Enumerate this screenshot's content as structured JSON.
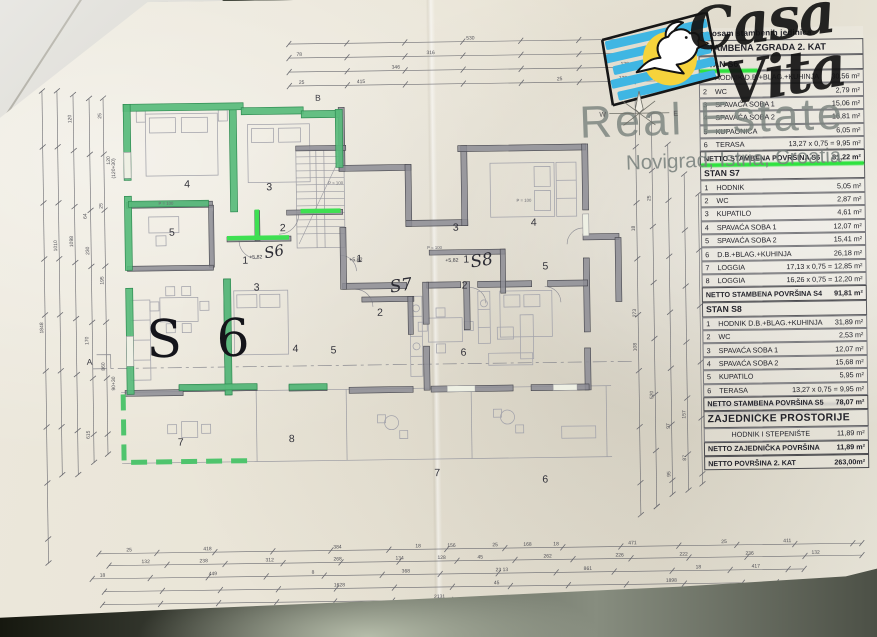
{
  "watermark": {
    "brand_script_1": "Casa",
    "brand_script_2": "Vita",
    "brand_line1": "Real Estate",
    "brand_line2": "Novigrad, Istria, Croatia"
  },
  "table": {
    "pre_title": "sa osam stambenih jedinica",
    "title": "STAMBENA ZGRADA 2. KAT",
    "rows": [
      {
        "type": "section",
        "label": "STAN S6",
        "highlight": "part"
      },
      {
        "type": "item",
        "n": "1",
        "label": "HODNIK D.B.+BLAG.+KUHINJA",
        "value": "30,56 m²"
      },
      {
        "type": "item",
        "n": "2",
        "label": "WC",
        "value": "2,79 m²"
      },
      {
        "type": "item",
        "n": "3",
        "label": "SPAVAĆA SOBA 1",
        "value": "15,06 m²"
      },
      {
        "type": "item",
        "n": "4",
        "label": "SPAVAĆA SOBA 2",
        "value": "16,81 m²"
      },
      {
        "type": "item",
        "n": "5",
        "label": "KUPAONICA",
        "value": "6,05 m²"
      },
      {
        "type": "item",
        "n": "6",
        "label": "TERASA",
        "value": "13,27 x 0,75 = 9,95 m²"
      },
      {
        "type": "total",
        "label": "NETTO STAMBENA POVRŠINA S6",
        "value": "81,22 m²",
        "highlight": "full"
      },
      {
        "type": "section",
        "label": "STAN S7"
      },
      {
        "type": "item",
        "n": "1",
        "label": "HODNIK",
        "value": "5,05 m²"
      },
      {
        "type": "item",
        "n": "2",
        "label": "WC",
        "value": "2,87 m²"
      },
      {
        "type": "item",
        "n": "3",
        "label": "KUPATILO",
        "value": "4,61 m²"
      },
      {
        "type": "item",
        "n": "4",
        "label": "SPAVAĆA SOBA 1",
        "value": "12,07 m²"
      },
      {
        "type": "item",
        "n": "5",
        "label": "SPAVAĆA SOBA 2",
        "value": "15,41 m²"
      },
      {
        "type": "item",
        "n": "6",
        "label": "D.B.+BLAG.+KUHINJA",
        "value": "26,18 m²"
      },
      {
        "type": "item",
        "n": "7",
        "label": "LOGGIA",
        "value": "17,13 x 0,75 = 12,85 m²"
      },
      {
        "type": "item",
        "n": "8",
        "label": "LOGGIA",
        "value": "16,26 x 0,75 = 12,20 m²"
      },
      {
        "type": "total",
        "label": "NETTO STAMBENA POVRŠINA S4",
        "value": "91,81 m²"
      },
      {
        "type": "section",
        "label": "STAN S8"
      },
      {
        "type": "item",
        "n": "1",
        "label": "HODNIK D.B.+BLAG.+KUHINJA",
        "value": "31,89 m²"
      },
      {
        "type": "item",
        "n": "2",
        "label": "WC",
        "value": "2,53 m²"
      },
      {
        "type": "item",
        "n": "3",
        "label": "SPAVAĆA SOBA 1",
        "value": "12,07 m²"
      },
      {
        "type": "item",
        "n": "4",
        "label": "SPAVAĆA SOBA 2",
        "value": "15,68 m²"
      },
      {
        "type": "item",
        "n": "5",
        "label": "KUPATILO",
        "value": "5,95 m²"
      },
      {
        "type": "item",
        "n": "6",
        "label": "TERASA",
        "value": "13,27 x 0,75 = 9,95 m²"
      },
      {
        "type": "total",
        "label": "NETTO STAMBENA POVRŠINA S5",
        "value": "78,07 m²"
      },
      {
        "type": "section-big",
        "label": "ZAJEDNIČKE PROSTORIJE"
      },
      {
        "type": "common",
        "label": "HODNIK I STEPENIŠTE",
        "value": "11,89 m²"
      },
      {
        "type": "total",
        "label": "NETTO ZAJEDNIČKA POVRŠINA",
        "value": "11,89 m²"
      },
      {
        "type": "total",
        "label": "NETTO POVRŠINA 2. KAT",
        "value": "263,00m²"
      }
    ]
  },
  "plan": {
    "big_unit_label": "S 6",
    "script_labels": [
      {
        "t": "S6",
        "x": 266,
        "y": 258,
        "s": 15,
        "r": -10
      },
      {
        "t": "S7",
        "x": 391,
        "y": 294,
        "s": 17,
        "r": -8
      },
      {
        "t": "S8",
        "x": 472,
        "y": 270,
        "s": 17,
        "r": -8
      }
    ],
    "room_numbers": [
      {
        "t": "4",
        "x": 186,
        "y": 186
      },
      {
        "t": "3",
        "x": 268,
        "y": 190
      },
      {
        "t": "5",
        "x": 170,
        "y": 234
      },
      {
        "t": "2",
        "x": 281,
        "y": 231
      },
      {
        "t": "1",
        "x": 243,
        "y": 263
      },
      {
        "t": "3",
        "x": 254,
        "y": 290
      },
      {
        "t": "4",
        "x": 292,
        "y": 352
      },
      {
        "t": "5",
        "x": 330,
        "y": 354
      },
      {
        "t": "7",
        "x": 176,
        "y": 444
      },
      {
        "t": "8",
        "x": 287,
        "y": 442
      },
      {
        "t": "1",
        "x": 357,
        "y": 263
      },
      {
        "t": "2",
        "x": 377,
        "y": 317
      },
      {
        "t": "6",
        "x": 460,
        "y": 358
      },
      {
        "t": "1",
        "x": 464,
        "y": 265
      },
      {
        "t": "2",
        "x": 462,
        "y": 291
      },
      {
        "t": "3",
        "x": 454,
        "y": 233
      },
      {
        "t": "4",
        "x": 532,
        "y": 229
      },
      {
        "t": "5",
        "x": 543,
        "y": 273
      },
      {
        "t": "7",
        "x": 432,
        "y": 478
      },
      {
        "t": "6",
        "x": 540,
        "y": 486
      }
    ],
    "level_marks": [
      {
        "t": "+5,82",
        "x": 250,
        "y": 258
      },
      {
        "t": "+5,82",
        "x": 350,
        "y": 262
      },
      {
        "t": "+5,82",
        "x": 446,
        "y": 264
      }
    ],
    "parapet_notes": [
      {
        "t": "P = 100",
        "x": 160,
        "y": 203
      },
      {
        "t": "P = 100",
        "x": 330,
        "y": 185
      },
      {
        "t": "P = 100",
        "x": 428,
        "y": 251
      },
      {
        "t": "P = 100",
        "x": 518,
        "y": 205
      }
    ],
    "grid_marks": [
      {
        "t": "B",
        "x": 318,
        "y": 101
      },
      {
        "t": "A",
        "x": 86,
        "y": 362
      }
    ],
    "dim_labels": [
      {
        "t": "530",
        "x": 470,
        "y": 42
      },
      {
        "t": "316",
        "x": 430,
        "y": 56
      },
      {
        "t": "78",
        "x": 300,
        "y": 56
      },
      {
        "t": "18",
        "x": 652,
        "y": 56
      },
      {
        "t": "346",
        "x": 395,
        "y": 70
      },
      {
        "t": "120",
        "x": 624,
        "y": 70
      },
      {
        "t": "132",
        "x": 662,
        "y": 70
      },
      {
        "t": "98",
        "x": 694,
        "y": 70
      },
      {
        "t": "25",
        "x": 302,
        "y": 84
      },
      {
        "t": "415",
        "x": 360,
        "y": 84
      },
      {
        "t": "25",
        "x": 560,
        "y": 84
      },
      {
        "t": "128",
        "x": 622,
        "y": 84
      },
      {
        "t": "95",
        "x": 668,
        "y": 84
      },
      {
        "t": "25",
        "x": 123,
        "y": 549
      },
      {
        "t": "418",
        "x": 200,
        "y": 549
      },
      {
        "t": "384",
        "x": 330,
        "y": 549
      },
      {
        "t": "18",
        "x": 412,
        "y": 549
      },
      {
        "t": "156",
        "x": 444,
        "y": 549
      },
      {
        "t": "25",
        "x": 489,
        "y": 549
      },
      {
        "t": "168",
        "x": 520,
        "y": 549
      },
      {
        "t": "18",
        "x": 550,
        "y": 549
      },
      {
        "t": "471",
        "x": 625,
        "y": 549
      },
      {
        "t": "25",
        "x": 718,
        "y": 549
      },
      {
        "t": "411",
        "x": 780,
        "y": 549
      },
      {
        "t": "132",
        "x": 138,
        "y": 561
      },
      {
        "t": "238",
        "x": 196,
        "y": 561
      },
      {
        "t": "312",
        "x": 262,
        "y": 561
      },
      {
        "t": "268",
        "x": 330,
        "y": 561
      },
      {
        "t": "134",
        "x": 392,
        "y": 561
      },
      {
        "t": "128",
        "x": 434,
        "y": 561
      },
      {
        "t": "45",
        "x": 474,
        "y": 561
      },
      {
        "t": "262",
        "x": 540,
        "y": 561
      },
      {
        "t": "226",
        "x": 612,
        "y": 561
      },
      {
        "t": "222",
        "x": 676,
        "y": 561
      },
      {
        "t": "236",
        "x": 742,
        "y": 561
      },
      {
        "t": "132",
        "x": 808,
        "y": 561
      },
      {
        "t": "18",
        "x": 96,
        "y": 574
      },
      {
        "t": "449",
        "x": 205,
        "y": 574
      },
      {
        "t": "8",
        "x": 308,
        "y": 574
      },
      {
        "t": "368",
        "x": 398,
        "y": 574
      },
      {
        "t": "23 13",
        "x": 492,
        "y": 574
      },
      {
        "t": "861",
        "x": 580,
        "y": 574
      },
      {
        "t": "18",
        "x": 692,
        "y": 574
      },
      {
        "t": "417",
        "x": 748,
        "y": 574
      },
      {
        "t": "1628",
        "x": 330,
        "y": 587
      },
      {
        "t": "45",
        "x": 490,
        "y": 587
      },
      {
        "t": "1898",
        "x": 662,
        "y": 587
      },
      {
        "t": "2131",
        "x": 430,
        "y": 600
      },
      {
        "t": "1848",
        "x": 43,
        "y": 330,
        "r": -90
      },
      {
        "t": "1010",
        "x": 58,
        "y": 248,
        "r": -90
      },
      {
        "t": "1098",
        "x": 74,
        "y": 244,
        "r": -90
      },
      {
        "t": "64",
        "x": 88,
        "y": 216,
        "r": -90
      },
      {
        "t": "230",
        "x": 90,
        "y": 252,
        "r": -90
      },
      {
        "t": "170",
        "x": 88,
        "y": 342,
        "r": -90
      },
      {
        "t": "860",
        "x": 104,
        "y": 368,
        "r": -90
      },
      {
        "t": "615",
        "x": 88,
        "y": 436,
        "r": -90
      },
      {
        "t": "195",
        "x": 104,
        "y": 282,
        "r": -90
      },
      {
        "t": "25",
        "x": 104,
        "y": 206,
        "r": -90
      },
      {
        "t": "120",
        "x": 74,
        "y": 120,
        "r": -90
      },
      {
        "t": "25",
        "x": 104,
        "y": 116,
        "r": -90
      },
      {
        "t": "25",
        "x": 652,
        "y": 206,
        "r": -90
      },
      {
        "t": "273",
        "x": 636,
        "y": 322,
        "r": -90
      },
      {
        "t": "108",
        "x": 636,
        "y": 356,
        "r": -90
      },
      {
        "t": "18",
        "x": 636,
        "y": 236,
        "r": -90
      },
      {
        "t": "520",
        "x": 652,
        "y": 404,
        "r": -90
      },
      {
        "t": "97",
        "x": 668,
        "y": 434,
        "r": -90
      },
      {
        "t": "95",
        "x": 668,
        "y": 482,
        "r": -90
      },
      {
        "t": "157",
        "x": 684,
        "y": 424,
        "r": -90
      },
      {
        "t": "87",
        "x": 684,
        "y": 466,
        "r": -90
      },
      {
        "t": "120",
        "x": 112,
        "y": 162,
        "r": -90
      },
      {
        "t": "(120+30)",
        "x": 117,
        "y": 176,
        "r": -90
      },
      {
        "t": "90+30",
        "x": 114,
        "y": 388,
        "r": -90
      }
    ]
  }
}
